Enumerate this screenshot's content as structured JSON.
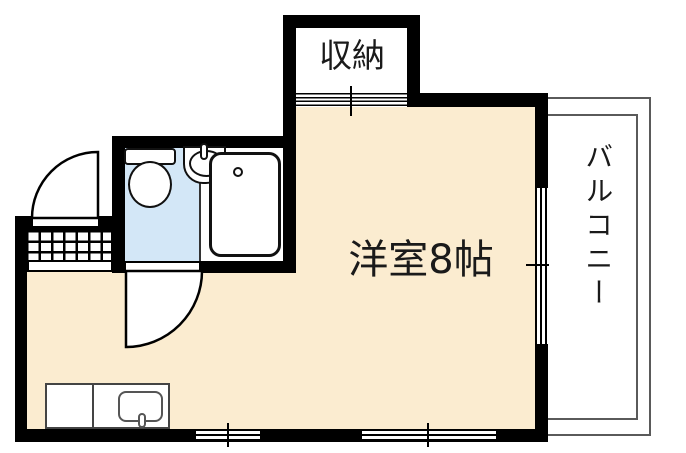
{
  "floorplan": {
    "labels": {
      "closet": "収納",
      "main_room": "洋室8帖",
      "balcony": "バルコニー"
    },
    "colors": {
      "wall": "#000000",
      "room_floor": "#FBECD0",
      "wet_area_floor": "#D3E7F7",
      "balcony_rail": "#5a5a5a",
      "background": "#ffffff"
    },
    "fixtures": [
      "toilet",
      "wash-basin",
      "bathtub",
      "kitchen-counter",
      "kitchen-sink",
      "entrance-mat",
      "entry-door",
      "bathroom-door",
      "closet-sliding-door",
      "balcony-sliding-window",
      "bottom-windows",
      "balcony-railing"
    ]
  }
}
